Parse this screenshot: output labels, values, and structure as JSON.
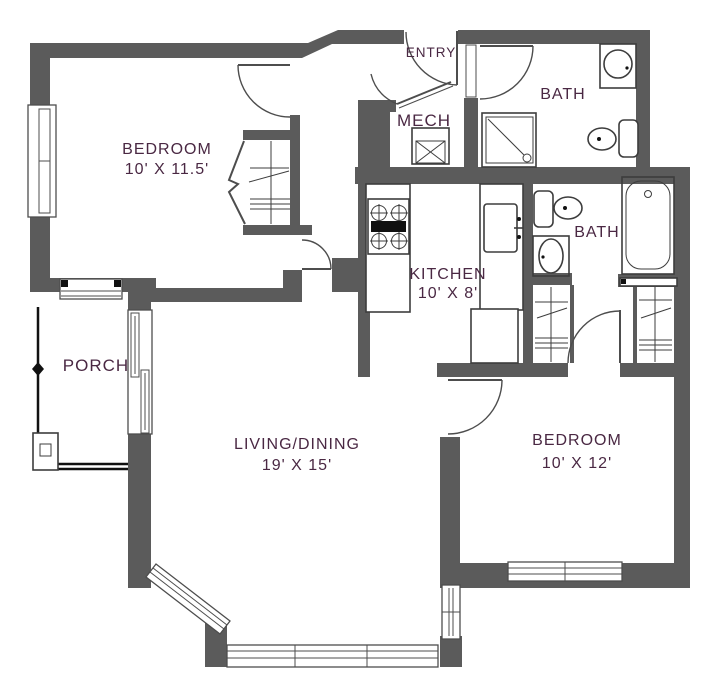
{
  "colors": {
    "wall": "#5b5b5b",
    "label": "#4a2843",
    "fixture": "#3d3d3d",
    "background": "#ffffff"
  },
  "rooms": {
    "bedroom1": {
      "label": "BEDROOM",
      "dims": "10' X 11.5'"
    },
    "entry": {
      "label": "ENTRY"
    },
    "bath1": {
      "label": "BATH"
    },
    "mech": {
      "label": "MECH"
    },
    "kitchen": {
      "label": "KITCHEN",
      "dims": "10' X 8'"
    },
    "bath2": {
      "label": "BATH"
    },
    "porch": {
      "label": "PORCH"
    },
    "living": {
      "label": "LIVING/DINING",
      "dims": "19' X 15'"
    },
    "bedroom2": {
      "label": "BEDROOM",
      "dims": "10' X 12'"
    }
  },
  "icons": [
    "stove-icon",
    "kitchen-sink-icon",
    "refrigerator-icon",
    "shower-icon",
    "sink-icon",
    "toilet-icon",
    "bathtub-icon",
    "water-heater-icon",
    "closet-rod-icon",
    "door-swing-icon",
    "window-icon",
    "porch-railing-icon"
  ]
}
